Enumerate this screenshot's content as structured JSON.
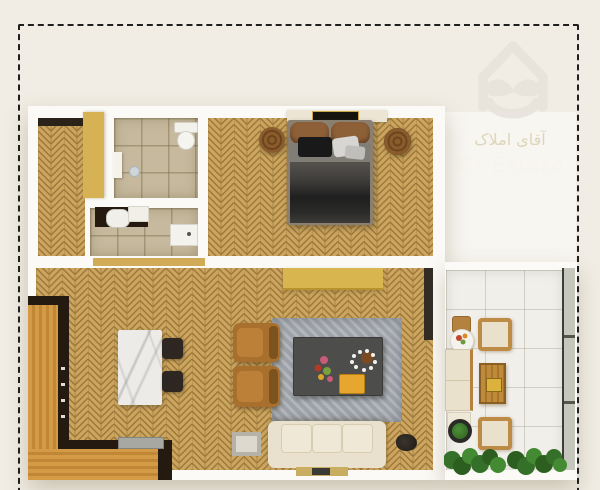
{
  "watermark": {
    "icon": "house-mustache-logo-icon",
    "line1_arabic": "آقای املاک",
    "line2_english": "Mr Estate"
  },
  "colors": {
    "background": "#f1ede4",
    "wall": "#fbfaf6",
    "dash": "#1f1f1f",
    "wood_base": "#cda55f",
    "wood_line": "#9b7a3c",
    "bath_tile": "#c7b99d",
    "balcony_tile": "#f1efea",
    "counter_wood_light": "#d49a45",
    "counter_wood_dark": "#c08836",
    "counter_edge": "#241a10",
    "marble": "#edebe7",
    "chair_dark": "#2e2620",
    "armchair": "#a8702c",
    "rug": "#a6abb1",
    "coffee_table": "#4d4d4b",
    "tray_yellow": "#e7a62e",
    "sofa": "#e9e1cd",
    "console_yellow": "#d8b54e",
    "door_yellow": "#d6b254",
    "lintel_dark": "#2b2219",
    "doorway_wood": "#d2ab58",
    "plant": "#3c7c2c",
    "railing": "#c6c7bc",
    "pouf": "#8a5c2c",
    "watermark_icon": "#e7e3dc",
    "watermark_arabic": "#d9cdae",
    "watermark_english": "#f7f4ed"
  }
}
